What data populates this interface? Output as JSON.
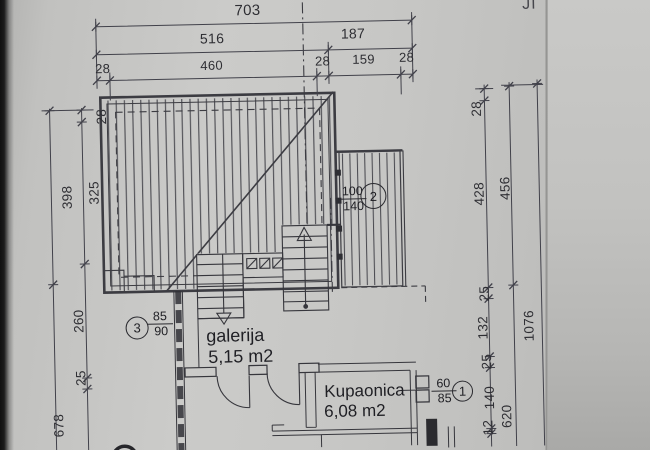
{
  "plan": {
    "orientation_label": "JI",
    "dims": {
      "top_total": "703",
      "top_row2": [
        "516",
        "187"
      ],
      "top_row3": [
        "28",
        "460",
        "28",
        "159",
        "28"
      ],
      "left_outer": [
        "398",
        "678"
      ],
      "left_inner": [
        "28",
        "325",
        "260",
        "25"
      ],
      "right_inner": [
        "28",
        "428",
        "25",
        "132",
        "25",
        "140",
        "12"
      ],
      "right_middle": [
        "456",
        "620"
      ],
      "right_outer": [
        "1076"
      ]
    },
    "rooms": {
      "galerija": {
        "name": "galerija",
        "area": "5,15 m2"
      },
      "kupaonica": {
        "name": "Kupaonica",
        "area": "6,08 m2"
      }
    },
    "openings": {
      "o1": {
        "id": "1",
        "w": "60",
        "h": "85"
      },
      "o2": {
        "id": "2",
        "w": "100",
        "h": "140"
      },
      "o3": {
        "id": "3",
        "w": "85",
        "h": "90"
      }
    },
    "colors": {
      "paper": "#c7c7c5",
      "ink": "#3c3c42"
    }
  }
}
